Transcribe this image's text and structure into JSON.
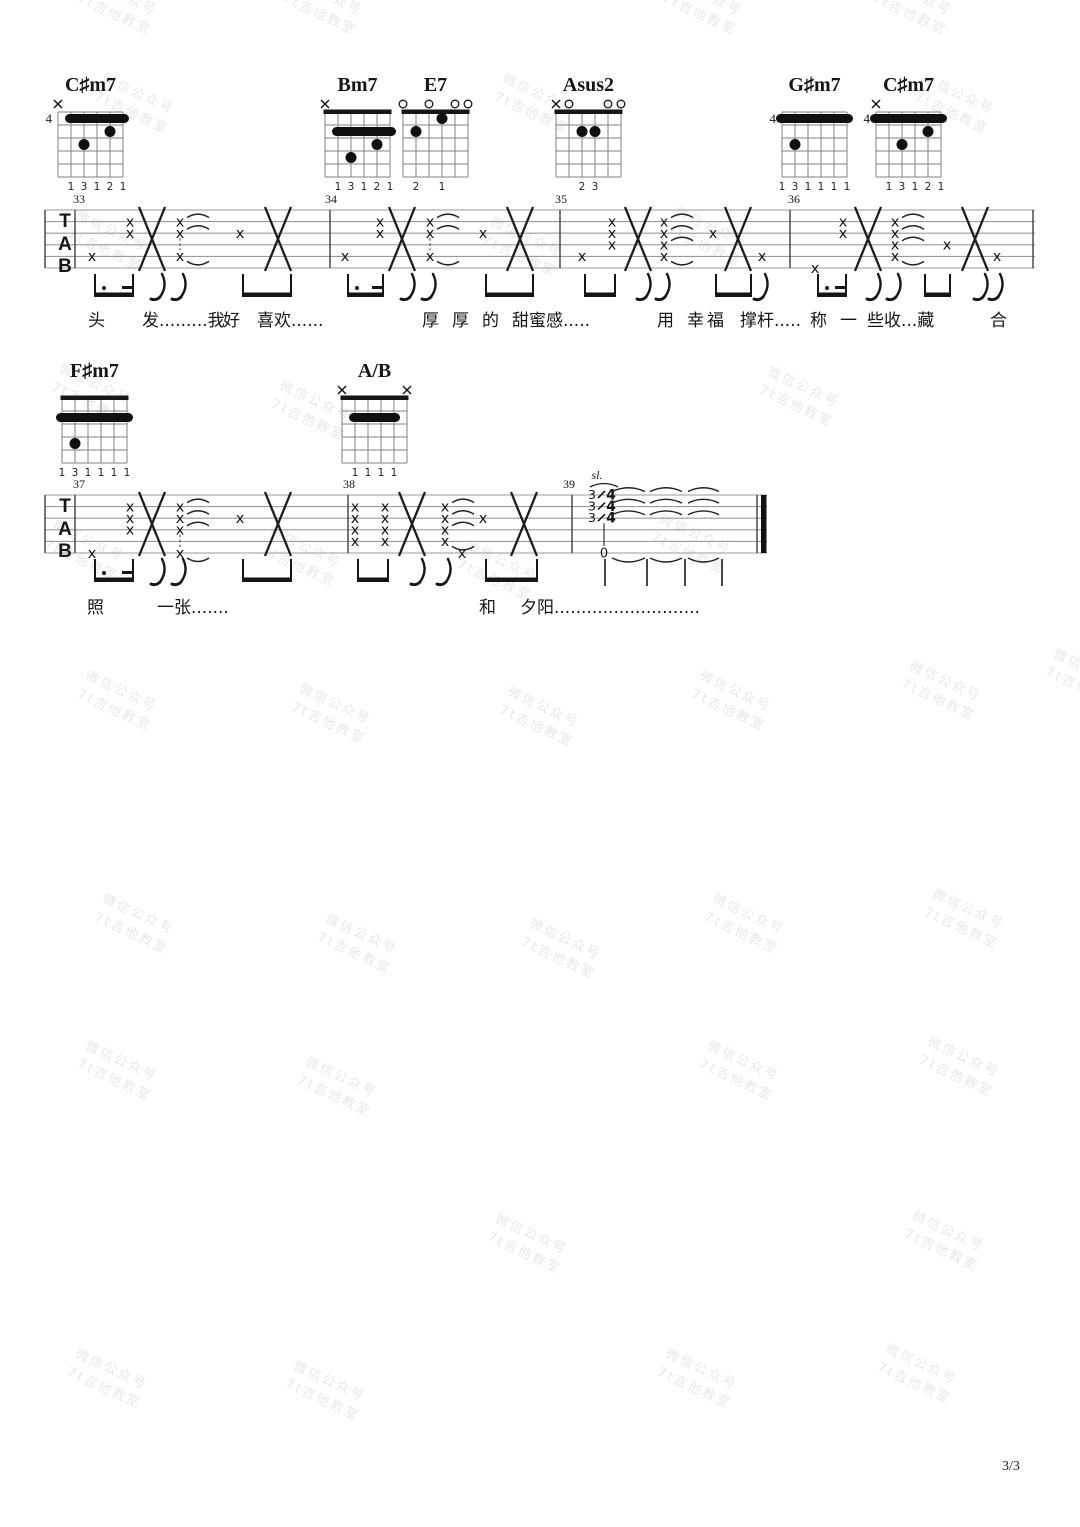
{
  "page": {
    "number_label": "3/3",
    "ink": "#161616",
    "staff_line_color": "#9a9a9a",
    "bar_color": "#3f3f3f"
  },
  "watermark": {
    "line1": "微信公众号",
    "line2": "7t吉他教室",
    "color": "#e8e8e8",
    "rotation_deg": 25,
    "positions": [
      [
        78,
        -14
      ],
      [
        283,
        -14
      ],
      [
        663,
        -14
      ],
      [
        873,
        -14
      ],
      [
        95,
        85
      ],
      [
        495,
        85
      ],
      [
        915,
        85
      ],
      [
        68,
        222
      ],
      [
        483,
        228
      ],
      [
        668,
        218
      ],
      [
        52,
        375
      ],
      [
        272,
        392
      ],
      [
        760,
        378
      ],
      [
        45,
        532
      ],
      [
        262,
        538
      ],
      [
        458,
        552
      ],
      [
        652,
        525
      ],
      [
        78,
        682
      ],
      [
        292,
        695
      ],
      [
        500,
        698
      ],
      [
        692,
        682
      ],
      [
        902,
        672
      ],
      [
        1046,
        660
      ],
      [
        95,
        905
      ],
      [
        318,
        925
      ],
      [
        522,
        930
      ],
      [
        705,
        905
      ],
      [
        925,
        900
      ],
      [
        78,
        1052
      ],
      [
        298,
        1068
      ],
      [
        700,
        1052
      ],
      [
        920,
        1048
      ],
      [
        488,
        1225
      ],
      [
        905,
        1222
      ],
      [
        68,
        1360
      ],
      [
        286,
        1372
      ],
      [
        658,
        1360
      ],
      [
        878,
        1355
      ]
    ]
  },
  "chords": [
    {
      "name": "C♯m7",
      "x": 58,
      "y": 112,
      "pos": "4",
      "nut": false,
      "markers": {
        "6": "x"
      },
      "barre": {
        "row": 1,
        "from": 5,
        "to": 1
      },
      "dots": [
        [
          2,
          2
        ],
        [
          4,
          3
        ]
      ],
      "fingers": {
        "5": "1",
        "4": "3",
        "3": "1",
        "2": "2",
        "1": "1"
      }
    },
    {
      "name": "Bm7",
      "x": 325,
      "y": 112,
      "pos": null,
      "nut": true,
      "markers": {
        "6": "x"
      },
      "barre": {
        "row": 2,
        "from": 5,
        "to": 1
      },
      "dots": [
        [
          2,
          3
        ],
        [
          4,
          4
        ]
      ],
      "fingers": {
        "5": "1",
        "4": "3",
        "3": "1",
        "2": "2",
        "1": "1"
      }
    },
    {
      "name": "E7",
      "x": 403,
      "y": 112,
      "pos": null,
      "nut": true,
      "markers": {
        "6": "o",
        "4": "o",
        "2": "o",
        "1": "o"
      },
      "barre": null,
      "dots": [
        [
          3,
          1
        ],
        [
          5,
          2
        ]
      ],
      "fingers": {
        "5": "2",
        "3": "1"
      }
    },
    {
      "name": "Asus2",
      "x": 556,
      "y": 112,
      "pos": null,
      "nut": true,
      "markers": {
        "6": "x",
        "5": "o",
        "2": "o",
        "1": "o"
      },
      "barre": null,
      "dots": [
        [
          4,
          2
        ],
        [
          3,
          2
        ]
      ],
      "fingers": {
        "4": "2",
        "3": "3"
      }
    },
    {
      "name": "G♯m7",
      "x": 782,
      "y": 112,
      "pos": "4",
      "nut": false,
      "markers": {},
      "barre": {
        "row": 1,
        "from": 6,
        "to": 1
      },
      "dots": [
        [
          5,
          3
        ]
      ],
      "fingers": {
        "6": "1",
        "5": "3",
        "4": "1",
        "3": "1",
        "2": "1",
        "1": "1"
      }
    },
    {
      "name": "C♯m7",
      "x": 876,
      "y": 112,
      "pos": "4",
      "nut": false,
      "markers": {
        "6": "x"
      },
      "barre": {
        "row": 1,
        "from": 6,
        "to": 1
      },
      "dots": [
        [
          2,
          2
        ],
        [
          4,
          3
        ]
      ],
      "fingers": {
        "5": "1",
        "4": "3",
        "3": "1",
        "2": "2",
        "1": "1"
      }
    },
    {
      "name": "F♯m7",
      "x": 62,
      "y": 398,
      "pos": null,
      "nut": true,
      "markers": {},
      "barre": {
        "row": 2,
        "from": 6,
        "to": 1
      },
      "dots": [
        [
          5,
          4
        ]
      ],
      "fingers": {
        "6": "1",
        "5": "3",
        "4": "1",
        "3": "1",
        "2": "1",
        "1": "1"
      }
    },
    {
      "name": "A/B",
      "x": 342,
      "y": 398,
      "pos": null,
      "nut": true,
      "markers": {
        "6": "x",
        "1": "x"
      },
      "barre": {
        "row": 2,
        "from": 5,
        "to": 2
      },
      "dots": [],
      "fingers": {
        "5": "1",
        "4": "1",
        "3": "1",
        "2": "1"
      }
    }
  ],
  "staves": [
    {
      "clef": "TAB",
      "x": 45,
      "y": 210,
      "gap": 11.6,
      "end_x": 1033,
      "end": "single",
      "barlines": [
        45,
        75,
        330,
        560,
        790
      ],
      "measures": [
        {
          "num": "33",
          "x": 75
        },
        {
          "num": "34",
          "x": 327
        },
        {
          "num": "35",
          "x": 557
        },
        {
          "num": "36",
          "x": 790
        }
      ],
      "events": [
        {
          "x": 92,
          "xs": [
            5
          ]
        },
        {
          "x": 130,
          "xs": [
            2,
            3
          ]
        },
        {
          "x": 152,
          "big": true
        },
        {
          "x": 180,
          "xs": [
            2,
            3,
            5
          ],
          "ties": true,
          "dash": true
        },
        {
          "x": 240,
          "xs": [
            3
          ]
        },
        {
          "x": 278,
          "big": true
        },
        {
          "x": 345,
          "xs": [
            5
          ]
        },
        {
          "x": 380,
          "xs": [
            2,
            3
          ]
        },
        {
          "x": 402,
          "big": true
        },
        {
          "x": 430,
          "xs": [
            2,
            3,
            5
          ],
          "ties": true,
          "dash": true
        },
        {
          "x": 483,
          "xs": [
            3
          ]
        },
        {
          "x": 520,
          "big": true
        },
        {
          "x": 582,
          "xs": [
            5
          ]
        },
        {
          "x": 612,
          "xs": [
            2,
            3,
            4
          ]
        },
        {
          "x": 638,
          "big": true
        },
        {
          "x": 664,
          "xs": [
            2,
            3,
            4,
            5
          ],
          "ties": true,
          "dash": true
        },
        {
          "x": 713,
          "xs": [
            3
          ]
        },
        {
          "x": 738,
          "big": true
        },
        {
          "x": 762,
          "xs": [
            5
          ]
        },
        {
          "x": 815,
          "xs": [
            6
          ]
        },
        {
          "x": 843,
          "xs": [
            2,
            3
          ]
        },
        {
          "x": 868,
          "big": true
        },
        {
          "x": 895,
          "xs": [
            2,
            3,
            4,
            5
          ],
          "ties": true,
          "dash": true
        },
        {
          "x": 947,
          "xs": [
            4
          ]
        },
        {
          "x": 975,
          "big": true
        },
        {
          "x": 997,
          "xs": [
            5
          ]
        }
      ],
      "rhythm": [
        {
          "k": "beam",
          "x1": 95,
          "x2": 133,
          "dot": true
        },
        {
          "k": "flag",
          "x": 162
        },
        {
          "k": "flag",
          "x": 183
        },
        {
          "k": "beam",
          "x1": 243,
          "x2": 291
        },
        {
          "k": "beam",
          "x1": 348,
          "x2": 383,
          "dot": true
        },
        {
          "k": "flag",
          "x": 412
        },
        {
          "k": "flag",
          "x": 433
        },
        {
          "k": "beam",
          "x1": 486,
          "x2": 533
        },
        {
          "k": "beam",
          "x1": 585,
          "x2": 615
        },
        {
          "k": "flag",
          "x": 648
        },
        {
          "k": "flag",
          "x": 667
        },
        {
          "k": "beam",
          "x1": 716,
          "x2": 751
        },
        {
          "k": "flag",
          "x": 765
        },
        {
          "k": "beam",
          "x1": 818,
          "x2": 846,
          "dot": true
        },
        {
          "k": "flag",
          "x": 878
        },
        {
          "k": "flag",
          "x": 898
        },
        {
          "k": "beam",
          "x1": 925,
          "x2": 950
        },
        {
          "k": "flag",
          "x": 985
        },
        {
          "k": "flag",
          "x": 1000
        }
      ],
      "lyrics_y": 306,
      "lyrics": [
        {
          "x": 88,
          "t": "头"
        },
        {
          "x": 142,
          "t": "发.........我"
        },
        {
          "x": 223,
          "t": "好"
        },
        {
          "x": 257,
          "t": "喜欢......"
        },
        {
          "x": 422,
          "t": "厚"
        },
        {
          "x": 452,
          "t": "厚"
        },
        {
          "x": 482,
          "t": "的"
        },
        {
          "x": 512,
          "t": "甜蜜感....."
        },
        {
          "x": 657,
          "t": "用"
        },
        {
          "x": 687,
          "t": "幸"
        },
        {
          "x": 707,
          "t": "福"
        },
        {
          "x": 740,
          "t": "撑杆....."
        },
        {
          "x": 810,
          "t": "称"
        },
        {
          "x": 840,
          "t": "一"
        },
        {
          "x": 867,
          "t": "些收...藏"
        },
        {
          "x": 990,
          "t": "合"
        }
      ]
    },
    {
      "clef": "TAB",
      "x": 45,
      "y": 495,
      "gap": 11.6,
      "end_x": 765,
      "end": "final",
      "barlines": [
        45,
        75,
        348,
        572
      ],
      "measures": [
        {
          "num": "37",
          "x": 75
        },
        {
          "num": "38",
          "x": 345
        },
        {
          "num": "39",
          "x": 565
        }
      ],
      "events": [
        {
          "x": 92,
          "xs": [
            6
          ]
        },
        {
          "x": 130,
          "xs": [
            2,
            3,
            4
          ]
        },
        {
          "x": 152,
          "big": true
        },
        {
          "x": 180,
          "xs": [
            2,
            3,
            4,
            6
          ],
          "ties": true,
          "dash": true
        },
        {
          "x": 240,
          "xs": [
            3
          ]
        },
        {
          "x": 278,
          "big": true
        },
        {
          "x": 355,
          "xs": [
            2,
            3,
            4,
            5
          ]
        },
        {
          "x": 385,
          "xs": [
            2,
            3,
            4,
            5
          ]
        },
        {
          "x": 412,
          "big": true
        },
        {
          "x": 445,
          "xs": [
            2,
            3,
            4,
            5
          ],
          "ties": true,
          "dash": true
        },
        {
          "x": 462,
          "xs": [
            6
          ]
        },
        {
          "x": 483,
          "xs": [
            3
          ]
        },
        {
          "x": 524,
          "big": true
        }
      ],
      "rhythm": [
        {
          "k": "beam",
          "x1": 95,
          "x2": 133,
          "dot": true
        },
        {
          "k": "flag",
          "x": 162
        },
        {
          "k": "flag",
          "x": 183
        },
        {
          "k": "beam",
          "x1": 243,
          "x2": 291
        },
        {
          "k": "beam",
          "x1": 358,
          "x2": 388
        },
        {
          "k": "flag",
          "x": 422
        },
        {
          "k": "flag",
          "x": 448
        },
        {
          "k": "beam",
          "x1": 486,
          "x2": 537
        }
      ],
      "lyrics_y": 593,
      "lyrics": [
        {
          "x": 87,
          "t": "照"
        },
        {
          "x": 157,
          "t": "一张......."
        },
        {
          "x": 479,
          "t": "和"
        },
        {
          "x": 520,
          "t": "夕阳..........................."
        }
      ],
      "coda": {
        "sl_label": "sl.",
        "sl_x": 597,
        "sl_y": 479,
        "slides": [
          {
            "string": 1,
            "x": 592,
            "from": "3",
            "to": "4"
          },
          {
            "string": 2,
            "x": 592,
            "from": "3",
            "to": "4"
          },
          {
            "string": 3,
            "x": 592,
            "from": "3",
            "to": "4"
          }
        ],
        "zero": {
          "label": "0",
          "x": 604,
          "string": 6
        },
        "arc_spans": [
          [
            612,
            645
          ],
          [
            650,
            682
          ],
          [
            688,
            719
          ]
        ],
        "arc_strings": [
          1,
          2,
          3
        ],
        "arc_down_string": 6,
        "stem_x": 604,
        "beat_stems": [
          605,
          647,
          685,
          722
        ]
      }
    }
  ]
}
